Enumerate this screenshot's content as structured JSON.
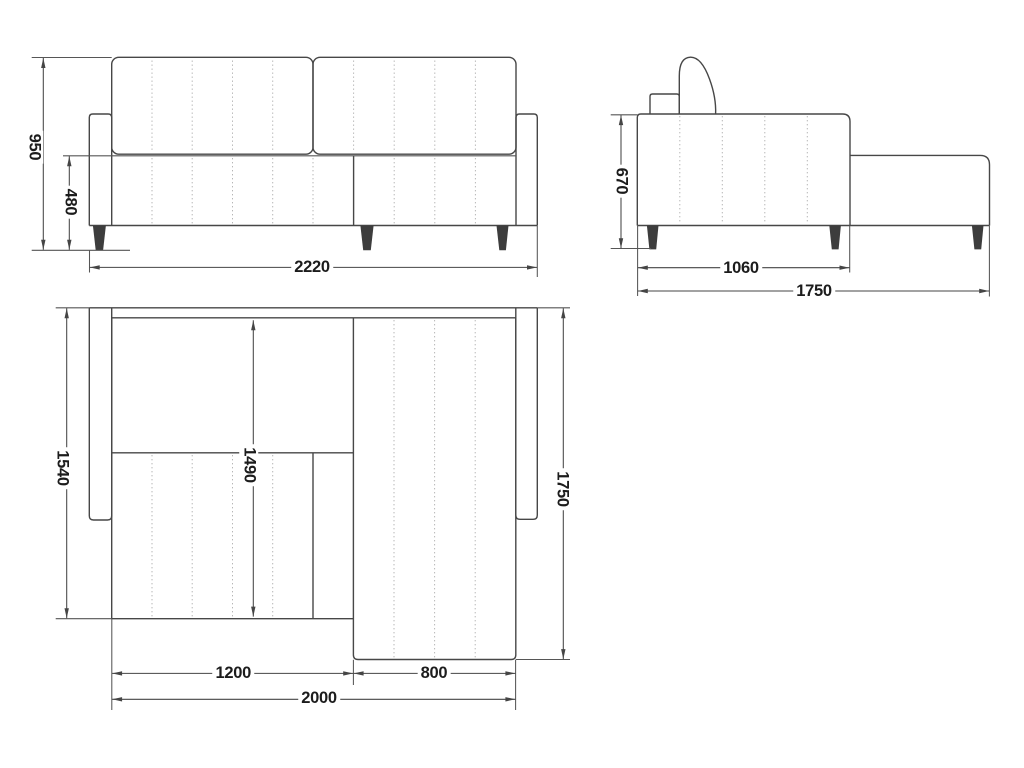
{
  "drawing": {
    "kind": "sofa-technical-drawing",
    "colors": {
      "background": "#ffffff",
      "object_line": "#474747",
      "dimension_line": "#454545",
      "stitch_dotted_line": "#b6b6b6",
      "leg_fill": "#3d3d3d",
      "label_text": "#1c1c1c"
    },
    "views": {
      "front": {
        "dims": {
          "total_height": "950",
          "seat_height": "480",
          "total_width": "2220"
        }
      },
      "side": {
        "dims": {
          "height": "670",
          "seat_depth": "1060",
          "total_depth": "1750"
        }
      },
      "top": {
        "dims": {
          "left_depth": "1540",
          "bed_length": "1490",
          "chaise_depth": "1750",
          "bed_section_width": "1200",
          "chaise_width": "800",
          "bed_width": "2000"
        }
      }
    }
  }
}
